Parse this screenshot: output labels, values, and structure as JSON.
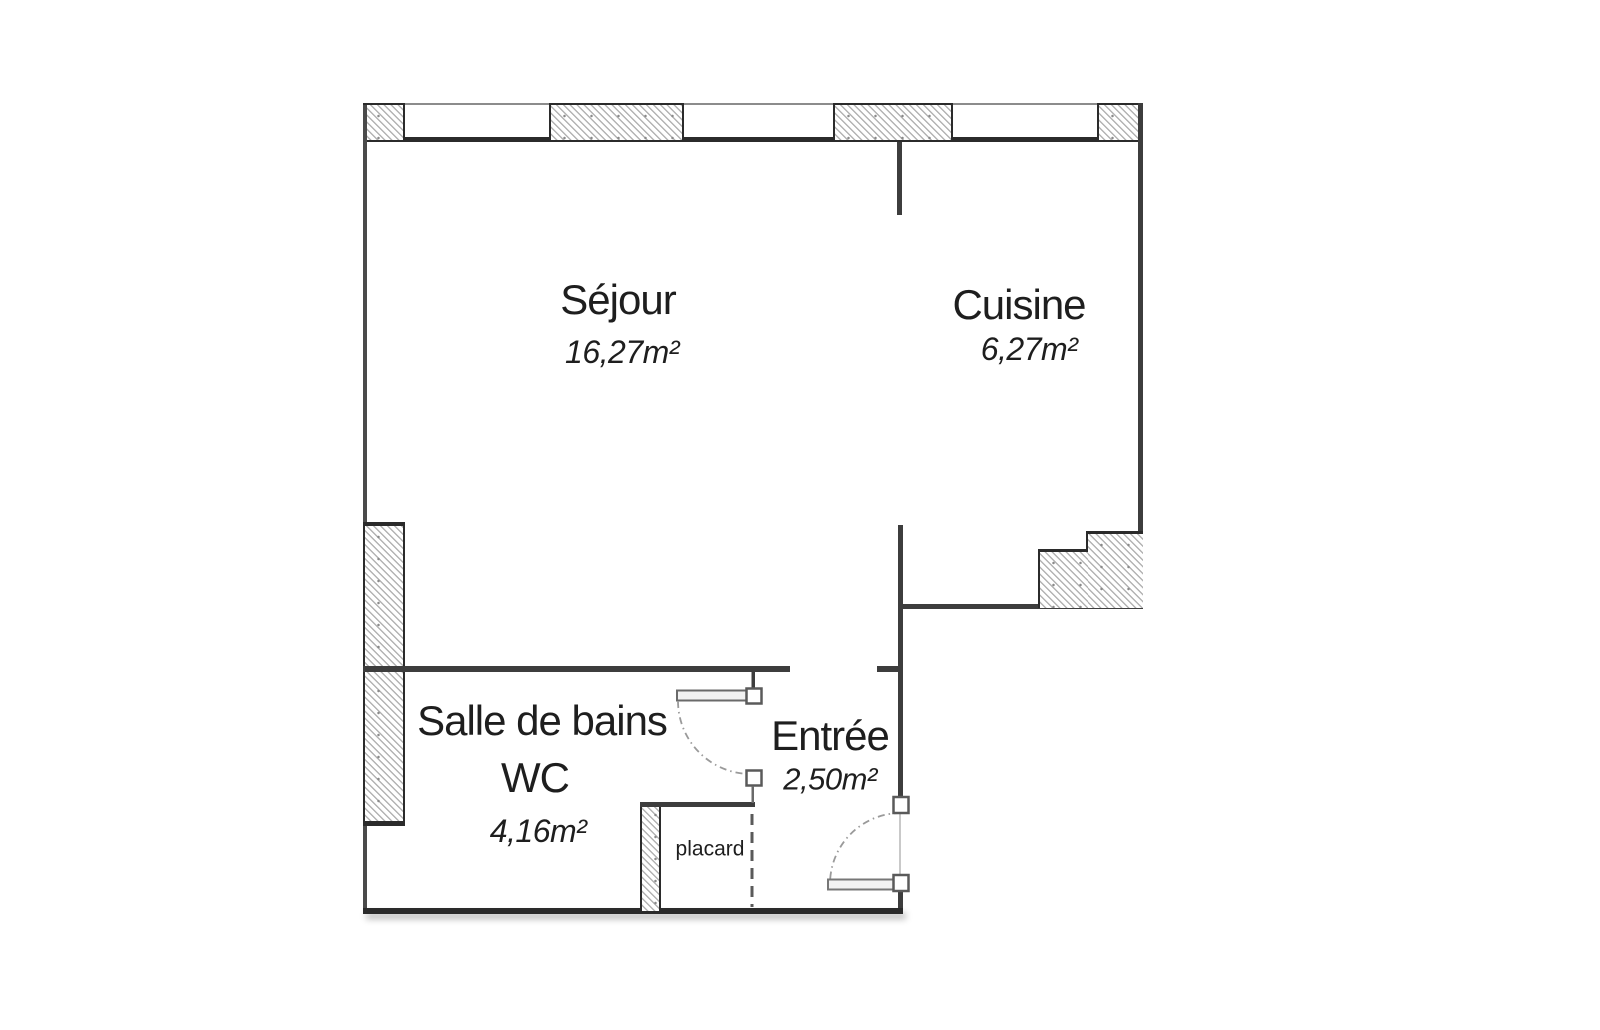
{
  "plan": {
    "type": "apartment-floor-plan",
    "language": "fr"
  },
  "rooms": [
    {
      "name": "Séjour",
      "area": "16,27m²"
    },
    {
      "name": "Cuisine",
      "area": "6,27m²"
    },
    {
      "name": "Salle de bains",
      "name_line2": "WC",
      "area": "4,16m²"
    },
    {
      "name": "Entrée",
      "area": "2,50m²"
    },
    {
      "name": "placard"
    }
  ],
  "colors": {
    "wall_thick": "#2b2b2b",
    "wall_medium": "#3d3d3d",
    "wall_outer_thin_line": "#8c8c8c",
    "hatch_line": "#b3b3b3",
    "door_arc": "#9a9a9a",
    "text": "#1e1e1e",
    "background": "#ffffff"
  }
}
